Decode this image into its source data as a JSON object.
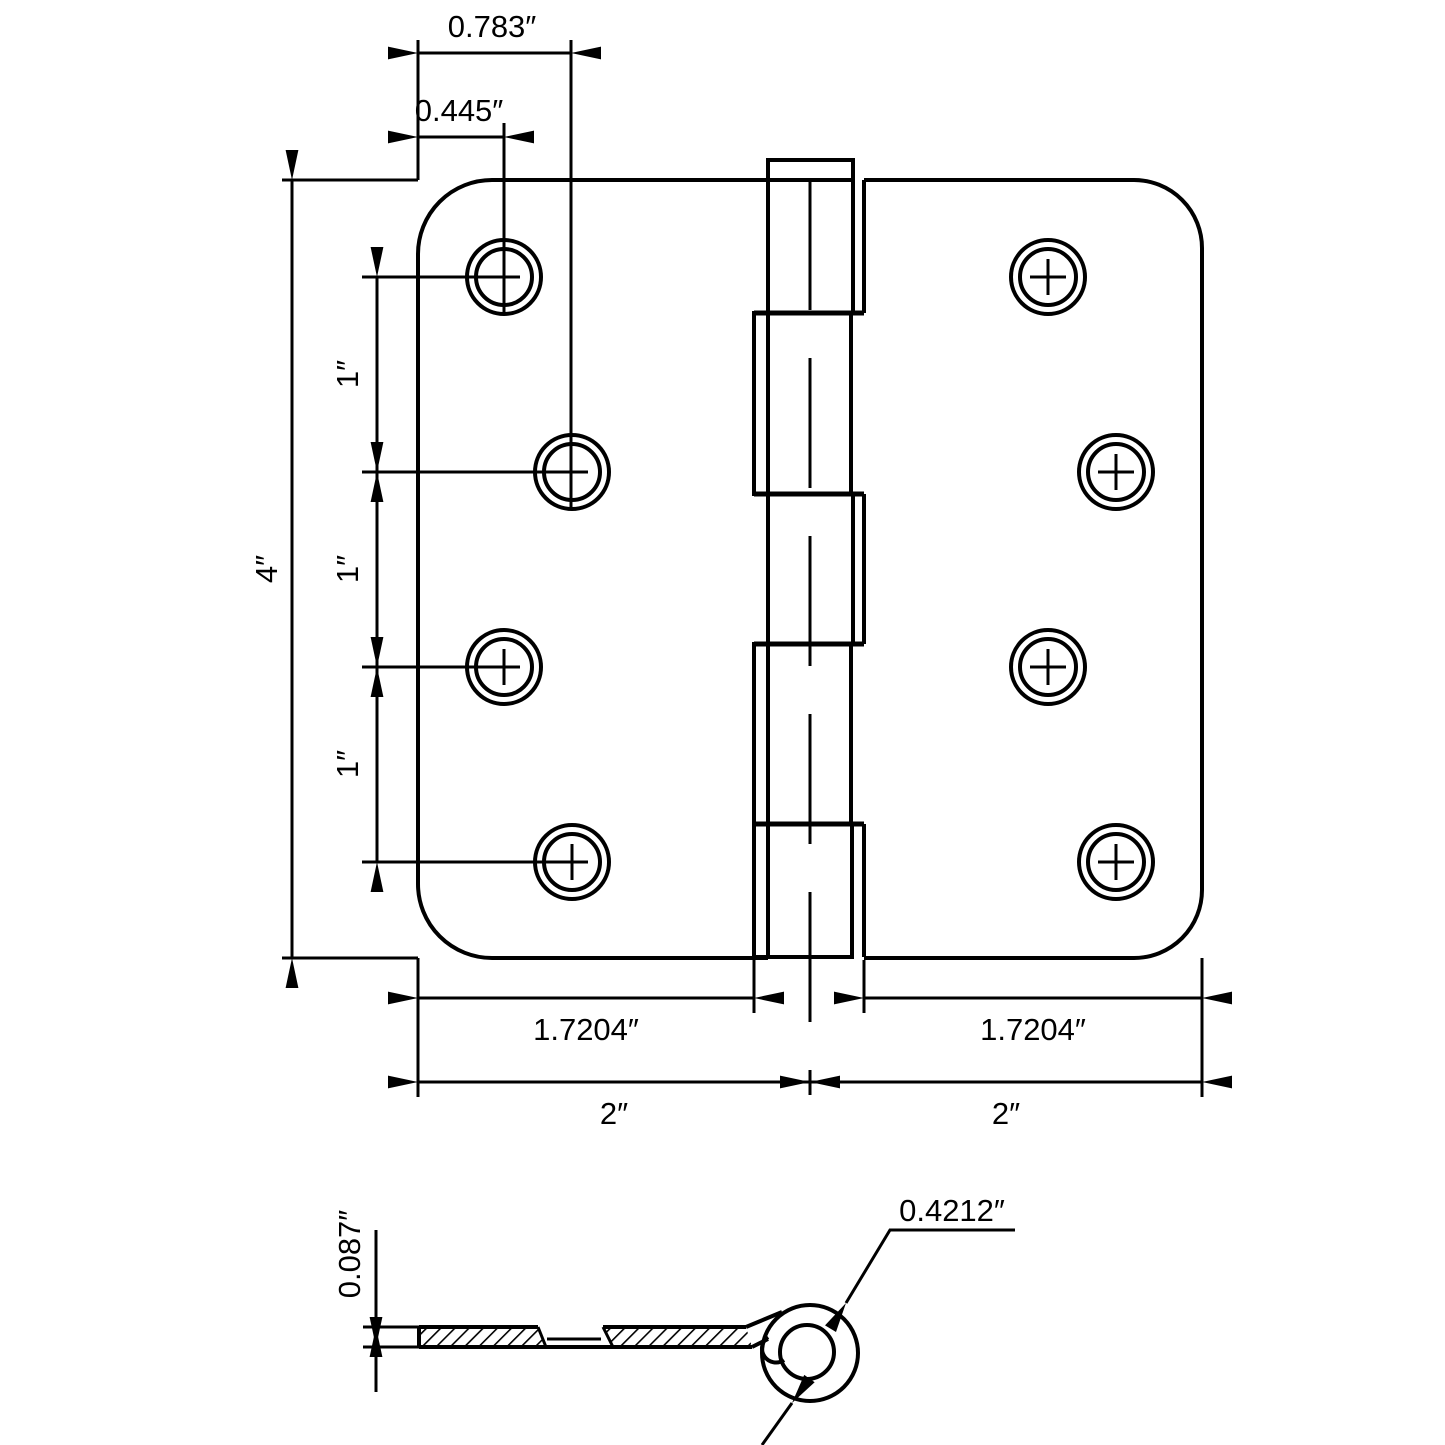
{
  "colors": {
    "line": "#000000",
    "background": "#ffffff"
  },
  "top_view": {
    "dims": {
      "top_outer": "0.783″",
      "top_inner": "0.445″",
      "height": "4″",
      "spacing_1": "1″",
      "spacing_2": "1″",
      "spacing_3": "1″",
      "leaf_left": "1.7204″",
      "leaf_right": "1.7204″",
      "half_left": "2″",
      "half_right": "2″"
    }
  },
  "profile_view": {
    "dims": {
      "thickness": "0.087″",
      "barrel_diameter": "0.4212″"
    }
  }
}
